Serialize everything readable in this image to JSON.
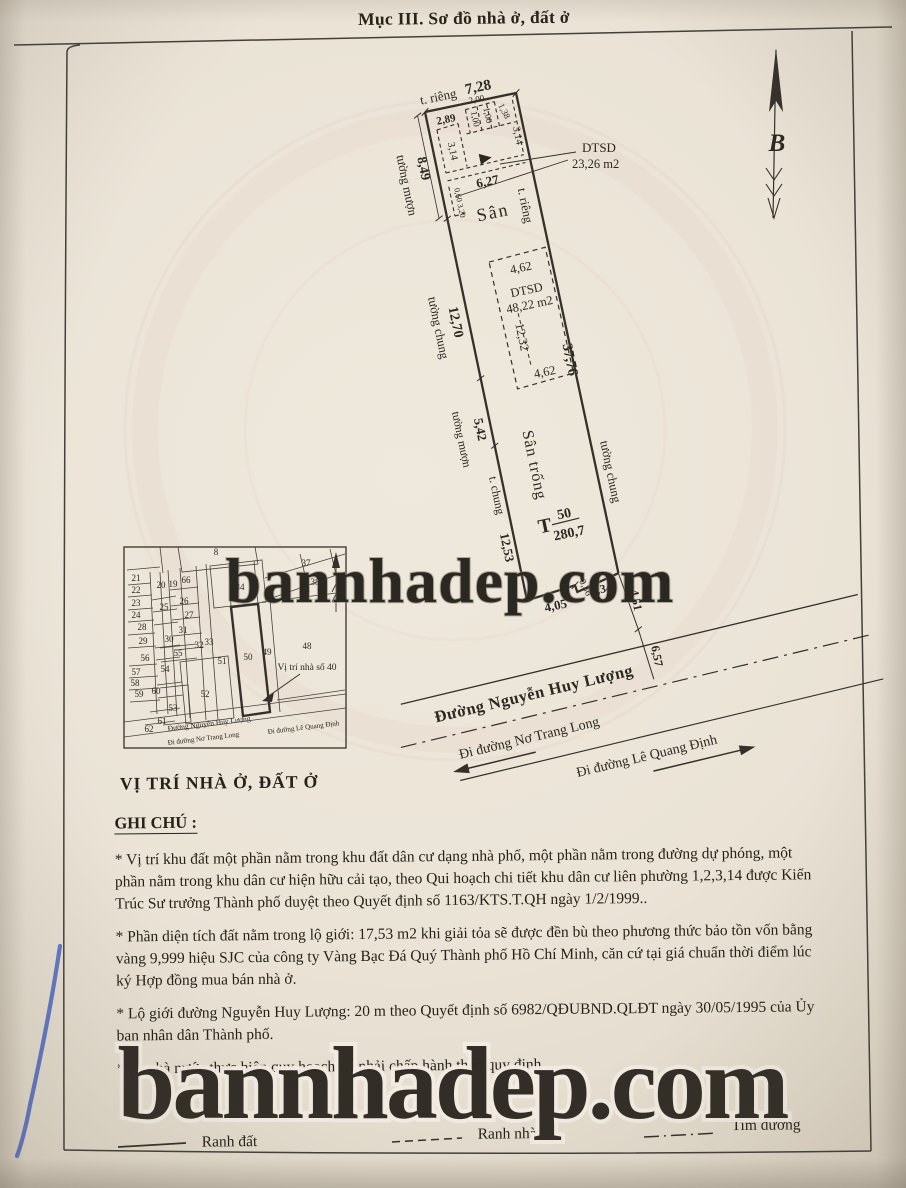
{
  "page": {
    "title": "Mục III. Sơ đồ nhà ở, đất ở",
    "watermark": "bannhadep.com"
  },
  "compass": {
    "letter": "B"
  },
  "plot": {
    "top_wall": "t. riêng",
    "top_dim": "7,28",
    "left": [
      {
        "dim": "8,49",
        "wall": "tường mượn"
      },
      {
        "dim": "12,70",
        "wall": "tường chung"
      },
      {
        "dim": "5,42",
        "wall": "tường mượn"
      },
      {
        "dim": "12,53",
        "wall": "t. chung"
      }
    ],
    "right": {
      "dim": "37,76",
      "wall": "tường chung",
      "inner_wall": "t. riêng"
    },
    "house1": {
      "name": "DTSD",
      "area": "23,26 m2",
      "d289": "2,89",
      "d200": "2,00",
      "d100a": "1,00",
      "d100b": "1,00",
      "d138": "1,38",
      "d314a": "3,14",
      "d314b": "3,14",
      "d627": "6,27",
      "d060": "0,60",
      "d320": "3,20"
    },
    "yard1": "Sân",
    "house2": {
      "name": "DTSD",
      "area": "48,22 m2",
      "top": "4,62",
      "height": "12,32",
      "bottom": "4,62"
    },
    "yard2": "Sân trống",
    "lot": {
      "prefix": "T",
      "number": "50",
      "area": "280,7"
    },
    "bottom": {
      "d036": "0,36",
      "d334": "3,34",
      "d405": "4,05",
      "d451": "4,51",
      "d657": "6,57"
    }
  },
  "streets": {
    "main": "Đường Nguyễn Huy Lượng",
    "to_left": "Đi đường Nơ Trang Long",
    "to_right": "Đi đường Lê Quang Định"
  },
  "inset": {
    "caption": "VỊ TRÍ NHÀ Ở, ĐẤT Ở",
    "target": "Vị trí nhà số 40",
    "street_main": "Đường Nguyễn Huy Lượng",
    "street_left": "Đi đường Nơ Trang Long",
    "street_right": "Đi đường Lê Quang Định",
    "parcels": [
      "8",
      "37",
      "38",
      "34",
      "66",
      "19",
      "20",
      "21",
      "22",
      "23",
      "25",
      "26",
      "24",
      "27",
      "28",
      "31",
      "29",
      "30",
      "32",
      "33",
      "56",
      "55",
      "54",
      "51",
      "50",
      "49",
      "48",
      "57",
      "58",
      "59",
      "60",
      "52",
      "53",
      "61",
      "62"
    ]
  },
  "notes": {
    "heading": "GHI CHÚ :",
    "items": [
      "* Vị trí khu đất một phần nằm trong khu đất dân cư dạng nhà phố, một phần nằm trong đường dự phóng, một phần nằm trong khu dân cư hiện hữu cải tạo, theo Qui hoạch chi tiết khu dân cư liên phường 1,2,3,14 được Kiến Trúc Sư trưởng Thành phố duyệt theo Quyết định số 1163/KTS.T.QH ngày 1/2/1999..",
      "* Phần diện tích đất nằm trong lộ giới: 17,53 m2 khi giải tỏa sẽ được đền bù theo phương thức bảo tồn vốn bằng vàng 9,999 hiệu SJC của công ty Vàng Bạc Đá Quý Thành phố Hồ Chí Minh, căn cứ tại giá chuẩn thời điểm lúc ký Hợp đồng mua bán nhà ở.",
      "* Lộ giới đường Nguyễn Huy Lượng: 20 m theo Quyết định số 6982/QĐUBND.QLĐT ngày 30/05/1995 của Ủy ban nhân dân Thành phố.",
      "* … nhà nước thực hiện quy hoạch … phải chấp hành theo quy định …"
    ]
  },
  "legend": {
    "items": [
      {
        "label": "Ranh đất"
      },
      {
        "label": "Ranh nhà"
      },
      {
        "label": "Tim đường"
      }
    ]
  }
}
